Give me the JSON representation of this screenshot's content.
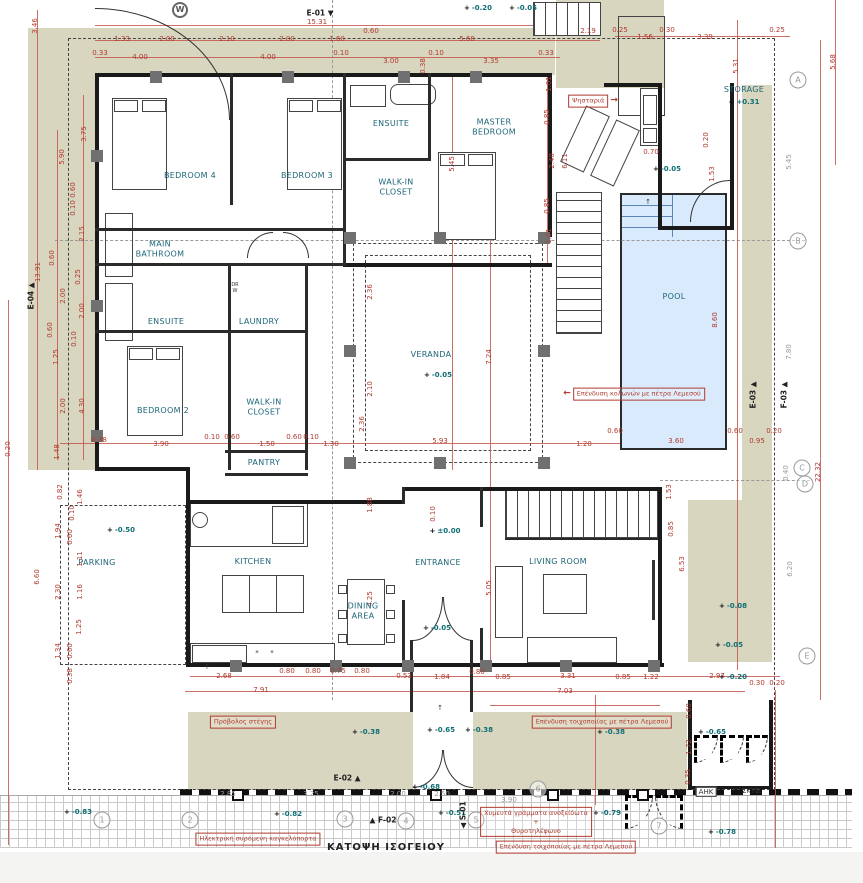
{
  "title": {
    "text": "ΚΑΤΟΨΗ ΙΣΟΓΕΙΟΥ"
  },
  "colors": {
    "dimension_red": "#b03a2e",
    "room_teal": "#1d6678",
    "level_teal": "#0f6f74",
    "terrace_beige": "#d9d6bf",
    "pool_blue": "#d9eafc",
    "wall_black": "#1a1a1a"
  },
  "rooms": [
    {
      "t": "BEDROOM 4",
      "x": 190,
      "y": 176
    },
    {
      "t": "BEDROOM 3",
      "x": 307,
      "y": 176
    },
    {
      "t": "ENSUITE",
      "x": 391,
      "y": 124
    },
    {
      "t": "MASTER\nBEDROOM",
      "x": 494,
      "y": 127
    },
    {
      "t": "WALK-IN\nCLOSET",
      "x": 396,
      "y": 187
    },
    {
      "t": "MAIN\nBATHROOM",
      "x": 160,
      "y": 249
    },
    {
      "t": "ENSUITE",
      "x": 166,
      "y": 322
    },
    {
      "t": "LAUNDRY",
      "x": 259,
      "y": 322
    },
    {
      "t": "BEDROOM 2",
      "x": 163,
      "y": 411
    },
    {
      "t": "WALK-IN\nCLOSET",
      "x": 264,
      "y": 407
    },
    {
      "t": "PANTRY",
      "x": 264,
      "y": 463
    },
    {
      "t": "VERANDA",
      "x": 431,
      "y": 355
    },
    {
      "t": "POOL",
      "x": 674,
      "y": 297
    },
    {
      "t": "STORAGE",
      "x": 744,
      "y": 90
    },
    {
      "t": "PARKING",
      "x": 97,
      "y": 563
    },
    {
      "t": "KITCHEN",
      "x": 253,
      "y": 562
    },
    {
      "t": "ENTRANCE",
      "x": 438,
      "y": 563
    },
    {
      "t": "DINING\nAREA",
      "x": 363,
      "y": 611
    },
    {
      "t": "LIVING ROOM",
      "x": 558,
      "y": 562
    }
  ],
  "levels": [
    {
      "t": "-0.20",
      "x": 478,
      "y": 8
    },
    {
      "t": "-0.05",
      "x": 523,
      "y": 8
    },
    {
      "t": "+0.31",
      "x": 744,
      "y": 102
    },
    {
      "t": "-0.05",
      "x": 667,
      "y": 169
    },
    {
      "t": "-0.05",
      "x": 438,
      "y": 375
    },
    {
      "t": "-0.50",
      "x": 121,
      "y": 530
    },
    {
      "t": "±0.00",
      "x": 445,
      "y": 531
    },
    {
      "t": "-0.05",
      "x": 437,
      "y": 628
    },
    {
      "t": "-0.08",
      "x": 733,
      "y": 606
    },
    {
      "t": "-0.05",
      "x": 729,
      "y": 645
    },
    {
      "t": "-0.20",
      "x": 733,
      "y": 677
    },
    {
      "t": "-0.38",
      "x": 366,
      "y": 732
    },
    {
      "t": "-0.65",
      "x": 441,
      "y": 730
    },
    {
      "t": "-0.38",
      "x": 479,
      "y": 730
    },
    {
      "t": "-0.38",
      "x": 611,
      "y": 732
    },
    {
      "t": "-0.65",
      "x": 712,
      "y": 732
    },
    {
      "t": "-0.68",
      "x": 426,
      "y": 787
    },
    {
      "t": "-0.82",
      "x": 288,
      "y": 814
    },
    {
      "t": "-0.83",
      "x": 78,
      "y": 812
    },
    {
      "t": "-0.79",
      "x": 607,
      "y": 813
    },
    {
      "t": "-0.51",
      "x": 452,
      "y": 813
    },
    {
      "t": "-0.78",
      "x": 722,
      "y": 832
    }
  ],
  "dims": [
    {
      "t": "15.31",
      "x": 317,
      "y": 22
    },
    {
      "t": "1.33",
      "x": 122,
      "y": 39
    },
    {
      "t": "2.00",
      "x": 167,
      "y": 39
    },
    {
      "t": "2.10",
      "x": 227,
      "y": 39
    },
    {
      "t": "2.00",
      "x": 287,
      "y": 39
    },
    {
      "t": "1.60",
      "x": 337,
      "y": 39
    },
    {
      "t": "0.60",
      "x": 371,
      "y": 31
    },
    {
      "t": "5.68",
      "x": 467,
      "y": 39
    },
    {
      "t": "2.19",
      "x": 588,
      "y": 31
    },
    {
      "t": "0.33",
      "x": 100,
      "y": 53
    },
    {
      "t": "4.00",
      "x": 140,
      "y": 57
    },
    {
      "t": "4.00",
      "x": 268,
      "y": 57
    },
    {
      "t": "0.10",
      "x": 341,
      "y": 53
    },
    {
      "t": "3.00",
      "x": 391,
      "y": 61
    },
    {
      "t": "0.10",
      "x": 436,
      "y": 53
    },
    {
      "t": "3.35",
      "x": 491,
      "y": 61
    },
    {
      "t": "0.33",
      "x": 546,
      "y": 53
    },
    {
      "t": "0.25",
      "x": 620,
      "y": 30
    },
    {
      "t": "1.56",
      "x": 645,
      "y": 37
    },
    {
      "t": "0.30",
      "x": 667,
      "y": 30
    },
    {
      "t": "3.39",
      "x": 705,
      "y": 37
    },
    {
      "t": "0.25",
      "x": 777,
      "y": 30
    },
    {
      "t": "5.31",
      "x": 736,
      "y": 66,
      "v": 1
    },
    {
      "t": "5.68",
      "x": 833,
      "y": 62,
      "v": 1
    },
    {
      "t": "3.46",
      "x": 35,
      "y": 26,
      "v": 1
    },
    {
      "t": "0.38",
      "x": 423,
      "y": 66,
      "v": 1
    },
    {
      "t": "3.75",
      "x": 84,
      "y": 134,
      "v": 1
    },
    {
      "t": "5.90",
      "x": 62,
      "y": 157,
      "v": 1
    },
    {
      "t": "0.60",
      "x": 73,
      "y": 190,
      "v": 1
    },
    {
      "t": "0.10",
      "x": 73,
      "y": 208,
      "v": 1
    },
    {
      "t": "2.15",
      "x": 82,
      "y": 234,
      "v": 1
    },
    {
      "t": "0.60",
      "x": 52,
      "y": 258,
      "v": 1
    },
    {
      "t": "13.91",
      "x": 38,
      "y": 272,
      "v": 1
    },
    {
      "t": "0.25",
      "x": 78,
      "y": 277,
      "v": 1
    },
    {
      "t": "2.00",
      "x": 63,
      "y": 296,
      "v": 1
    },
    {
      "t": "2.00",
      "x": 82,
      "y": 311,
      "v": 1
    },
    {
      "t": "0.60",
      "x": 50,
      "y": 330,
      "v": 1
    },
    {
      "t": "0.10",
      "x": 74,
      "y": 339,
      "v": 1
    },
    {
      "t": "1.25",
      "x": 56,
      "y": 357,
      "v": 1
    },
    {
      "t": "2.00",
      "x": 63,
      "y": 406,
      "v": 1
    },
    {
      "t": "4.30",
      "x": 82,
      "y": 406,
      "v": 1
    },
    {
      "t": "1.48",
      "x": 57,
      "y": 452,
      "v": 1
    },
    {
      "t": "0.20",
      "x": 8,
      "y": 449,
      "v": 1
    },
    {
      "t": "0.82",
      "x": 60,
      "y": 492,
      "v": 1
    },
    {
      "t": "1.46",
      "x": 80,
      "y": 497,
      "v": 1
    },
    {
      "t": "0.10",
      "x": 72,
      "y": 513,
      "v": 1
    },
    {
      "t": "1.94",
      "x": 58,
      "y": 531,
      "v": 1
    },
    {
      "t": "0.60",
      "x": 70,
      "y": 537,
      "v": 1
    },
    {
      "t": "1.11",
      "x": 80,
      "y": 559,
      "v": 1
    },
    {
      "t": "6.60",
      "x": 37,
      "y": 577,
      "v": 1
    },
    {
      "t": "2.30",
      "x": 58,
      "y": 592,
      "v": 1
    },
    {
      "t": "1.16",
      "x": 80,
      "y": 592,
      "v": 1
    },
    {
      "t": "1.25",
      "x": 79,
      "y": 627,
      "v": 1
    },
    {
      "t": "1.34",
      "x": 58,
      "y": 651,
      "v": 1
    },
    {
      "t": "0.60",
      "x": 70,
      "y": 651,
      "v": 1
    },
    {
      "t": "0.38",
      "x": 70,
      "y": 676,
      "v": 1
    },
    {
      "t": "0.38",
      "x": 99,
      "y": 440
    },
    {
      "t": "3.90",
      "x": 161,
      "y": 444
    },
    {
      "t": "0.10",
      "x": 212,
      "y": 437
    },
    {
      "t": "0.60",
      "x": 232,
      "y": 437
    },
    {
      "t": "1.50",
      "x": 267,
      "y": 444
    },
    {
      "t": "0.60",
      "x": 294,
      "y": 437
    },
    {
      "t": "0.10",
      "x": 311,
      "y": 437
    },
    {
      "t": "1.30",
      "x": 331,
      "y": 444
    },
    {
      "t": "5.93",
      "x": 440,
      "y": 441
    },
    {
      "t": "1.20",
      "x": 584,
      "y": 444
    },
    {
      "t": "0.60",
      "x": 615,
      "y": 431
    },
    {
      "t": "3.60",
      "x": 676,
      "y": 441
    },
    {
      "t": "0.60",
      "x": 735,
      "y": 431
    },
    {
      "t": "0.95",
      "x": 757,
      "y": 441
    },
    {
      "t": "0.20",
      "x": 774,
      "y": 431
    },
    {
      "t": "8.60",
      "x": 715,
      "y": 320,
      "v": 1
    },
    {
      "t": "7.80",
      "x": 789,
      "y": 352,
      "v": 1,
      "g": 1
    },
    {
      "t": "22.32",
      "x": 818,
      "y": 472,
      "v": 1
    },
    {
      "t": "5.45",
      "x": 452,
      "y": 164,
      "v": 1
    },
    {
      "t": "2.40",
      "x": 552,
      "y": 161,
      "v": 1
    },
    {
      "t": "6.11",
      "x": 565,
      "y": 161,
      "v": 1
    },
    {
      "t": "0.85",
      "x": 547,
      "y": 117,
      "v": 1
    },
    {
      "t": "1.01",
      "x": 549,
      "y": 84,
      "v": 1
    },
    {
      "t": "0.85",
      "x": 547,
      "y": 206,
      "v": 1
    },
    {
      "t": "1.01",
      "x": 549,
      "y": 236,
      "v": 1
    },
    {
      "t": "0.20",
      "x": 706,
      "y": 140,
      "v": 1
    },
    {
      "t": "1.53",
      "x": 712,
      "y": 174,
      "v": 1
    },
    {
      "t": "0.70",
      "x": 651,
      "y": 152
    },
    {
      "t": "5.45",
      "x": 789,
      "y": 162,
      "v": 1,
      "g": 1
    },
    {
      "t": "2.36",
      "x": 370,
      "y": 292,
      "v": 1
    },
    {
      "t": "2.10",
      "x": 370,
      "y": 389,
      "v": 1
    },
    {
      "t": "2.36",
      "x": 362,
      "y": 424,
      "v": 1
    },
    {
      "t": "7.24",
      "x": 489,
      "y": 357,
      "v": 1
    },
    {
      "t": "1.88",
      "x": 370,
      "y": 505,
      "v": 1
    },
    {
      "t": "4.25",
      "x": 370,
      "y": 599,
      "v": 1
    },
    {
      "t": "5.05",
      "x": 489,
      "y": 588,
      "v": 1
    },
    {
      "t": "0.10",
      "x": 433,
      "y": 514,
      "v": 1
    },
    {
      "t": "1.53",
      "x": 669,
      "y": 492,
      "v": 1
    },
    {
      "t": "0.85",
      "x": 671,
      "y": 529,
      "v": 1
    },
    {
      "t": "6.53",
      "x": 682,
      "y": 564,
      "v": 1
    },
    {
      "t": "0.40",
      "x": 786,
      "y": 473,
      "v": 1,
      "g": 1
    },
    {
      "t": "6.20",
      "x": 790,
      "y": 569,
      "v": 1,
      "g": 1
    },
    {
      "t": "2.68",
      "x": 224,
      "y": 676
    },
    {
      "t": "0.80",
      "x": 287,
      "y": 671
    },
    {
      "t": "0.80",
      "x": 313,
      "y": 671
    },
    {
      "t": "0.75",
      "x": 338,
      "y": 671
    },
    {
      "t": "0.80",
      "x": 362,
      "y": 671
    },
    {
      "t": "0.53",
      "x": 404,
      "y": 676
    },
    {
      "t": "1.84",
      "x": 442,
      "y": 677
    },
    {
      "t": "0.80",
      "x": 477,
      "y": 672
    },
    {
      "t": "0.85",
      "x": 503,
      "y": 677
    },
    {
      "t": "3.31",
      "x": 568,
      "y": 676
    },
    {
      "t": "0.85",
      "x": 623,
      "y": 677
    },
    {
      "t": "1.22",
      "x": 651,
      "y": 677
    },
    {
      "t": "2.97",
      "x": 717,
      "y": 676
    },
    {
      "t": "0.30",
      "x": 757,
      "y": 683
    },
    {
      "t": "0.20",
      "x": 777,
      "y": 683
    },
    {
      "t": "7.91",
      "x": 261,
      "y": 690
    },
    {
      "t": "7.03",
      "x": 565,
      "y": 691
    },
    {
      "t": "0.60",
      "x": 689,
      "y": 711,
      "v": 1
    },
    {
      "t": "1.72",
      "x": 689,
      "y": 747,
      "v": 1
    },
    {
      "t": "0.35",
      "x": 688,
      "y": 777,
      "v": 1
    },
    {
      "t": "2.85",
      "x": 228,
      "y": 794,
      "g": 1
    },
    {
      "t": "3.25",
      "x": 311,
      "y": 794,
      "g": 1
    },
    {
      "t": "2.00",
      "x": 398,
      "y": 794,
      "g": 1
    },
    {
      "t": "2.50",
      "x": 442,
      "y": 794,
      "g": 1
    },
    {
      "t": "3.90",
      "x": 509,
      "y": 800,
      "g": 1
    }
  ],
  "grid_bubbles": [
    {
      "t": "A",
      "x": 798,
      "y": 80
    },
    {
      "t": "B",
      "x": 798,
      "y": 241
    },
    {
      "t": "C",
      "x": 802,
      "y": 468
    },
    {
      "t": "D",
      "x": 805,
      "y": 484
    },
    {
      "t": "E",
      "x": 807,
      "y": 656
    },
    {
      "t": "1",
      "x": 102,
      "y": 820
    },
    {
      "t": "2",
      "x": 190,
      "y": 820
    },
    {
      "t": "3",
      "x": 345,
      "y": 819
    },
    {
      "t": "4",
      "x": 406,
      "y": 821
    },
    {
      "t": "5",
      "x": 476,
      "y": 820
    },
    {
      "t": "6",
      "x": 538,
      "y": 789
    },
    {
      "t": "7",
      "x": 659,
      "y": 826
    }
  ],
  "section_markers": [
    {
      "t": "E-01",
      "x": 320,
      "y": 13,
      "tri": "▼",
      "side": "after"
    },
    {
      "t": "E-02",
      "x": 347,
      "y": 778,
      "tri": "▲",
      "side": "after"
    },
    {
      "t": "F-02",
      "x": 383,
      "y": 820,
      "tri": "▲",
      "side": "before"
    },
    {
      "t": "E-03",
      "x": 753,
      "y": 395,
      "tri": "▲",
      "side": "after",
      "v": 1
    },
    {
      "t": "F-03",
      "x": 784,
      "y": 395,
      "tri": "▲",
      "side": "after",
      "v": 1
    },
    {
      "t": "E-04",
      "x": 31,
      "y": 296,
      "tri": "▲",
      "side": "after",
      "v": 1
    },
    {
      "t": "S-01",
      "x": 463,
      "y": 815,
      "tri": "◀",
      "side": "before",
      "v": 1
    }
  ],
  "annotations": [
    {
      "t": "Ψησταριά",
      "x": 593,
      "y": 101,
      "arrow": "→"
    },
    {
      "t": "Επένδυση κολωνών με πέτρα Λεμεσού",
      "x": 634,
      "y": 394,
      "arrow": "←",
      "before": 1
    },
    {
      "t": "Πρόβολος στέγης",
      "x": 243,
      "y": 722
    },
    {
      "t": "Επένδυση τοιχοποιίας με πέτρα Λεμεσού",
      "x": 602,
      "y": 722
    },
    {
      "t": "Ηλεκτρική συρόμενη καγκελόπορτα",
      "x": 258,
      "y": 839
    },
    {
      "t": "Χυμευτά γράμματα ανοξείδωτα\n+\nΘυροτηλέφωνο",
      "x": 536,
      "y": 822
    },
    {
      "t": "Επένδυση τοιχοποιίας με πέτρα Λεμεσού",
      "x": 566,
      "y": 847
    }
  ],
  "extra_labels": [
    {
      "t": "ΣΚΥΒ.",
      "x": 752,
      "y": 791
    },
    {
      "t": "ΑΗΚ",
      "x": 706,
      "y": 792,
      "box": 1
    },
    {
      "t": "DR\nW",
      "x": 235,
      "y": 288,
      "s": 5
    },
    {
      "t": "*",
      "x": 257,
      "y": 653
    },
    {
      "t": "*",
      "x": 272,
      "y": 653
    },
    {
      "t": "↑",
      "x": 440,
      "y": 708
    },
    {
      "t": "↑",
      "x": 648,
      "y": 202
    },
    {
      "t": "↑",
      "x": 207,
      "y": 667
    },
    {
      "t": "W",
      "x": 180,
      "y": 10,
      "circle": 1
    }
  ]
}
